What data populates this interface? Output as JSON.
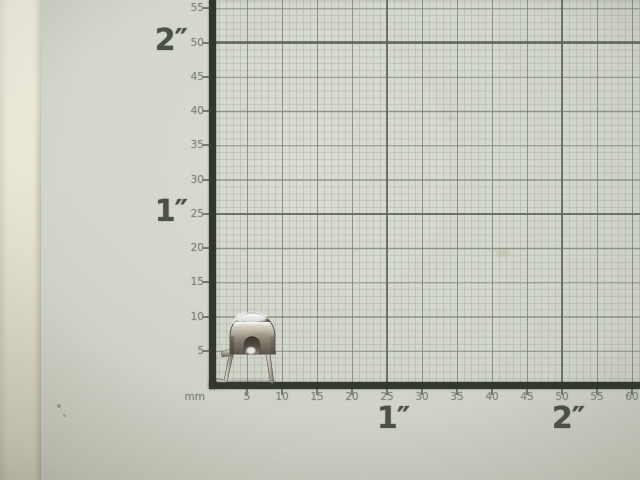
{
  "photo": {
    "description": "Small polished nickel-plated arch-shaped clip with two wire legs standing on a millimeter grid measuring mat",
    "object_name": "metal clip"
  },
  "ruler": {
    "unit_label": "mm",
    "y_tick_values": [
      55,
      50,
      45,
      40,
      35,
      30,
      25,
      20,
      15,
      10,
      5
    ],
    "x_tick_values": [
      5,
      10,
      15,
      20,
      25,
      30,
      35,
      40,
      45,
      50,
      55,
      60
    ],
    "y_inch_labels": [
      {
        "text": "2″",
        "mm": 50
      },
      {
        "text": "1″",
        "mm": 25
      }
    ],
    "x_inch_labels": [
      {
        "text": "1″",
        "mm": 25
      },
      {
        "text": "2″",
        "mm": 50
      }
    ]
  },
  "colors": {
    "backing_strip": "#e9e6d5",
    "paper": "#d3d6cb",
    "grid_minor": "rgba(148,157,142,0.32)",
    "grid_major": "rgba(108,118,103,0.62)",
    "grid_inch": "#5f675b",
    "axis": "#31372f",
    "tick_label": "#828880",
    "inch_label": "#4c5148",
    "metal_highlight": "#f4f2ea",
    "metal_mid": "#b5b0a4",
    "metal_dark": "#4a453d"
  }
}
